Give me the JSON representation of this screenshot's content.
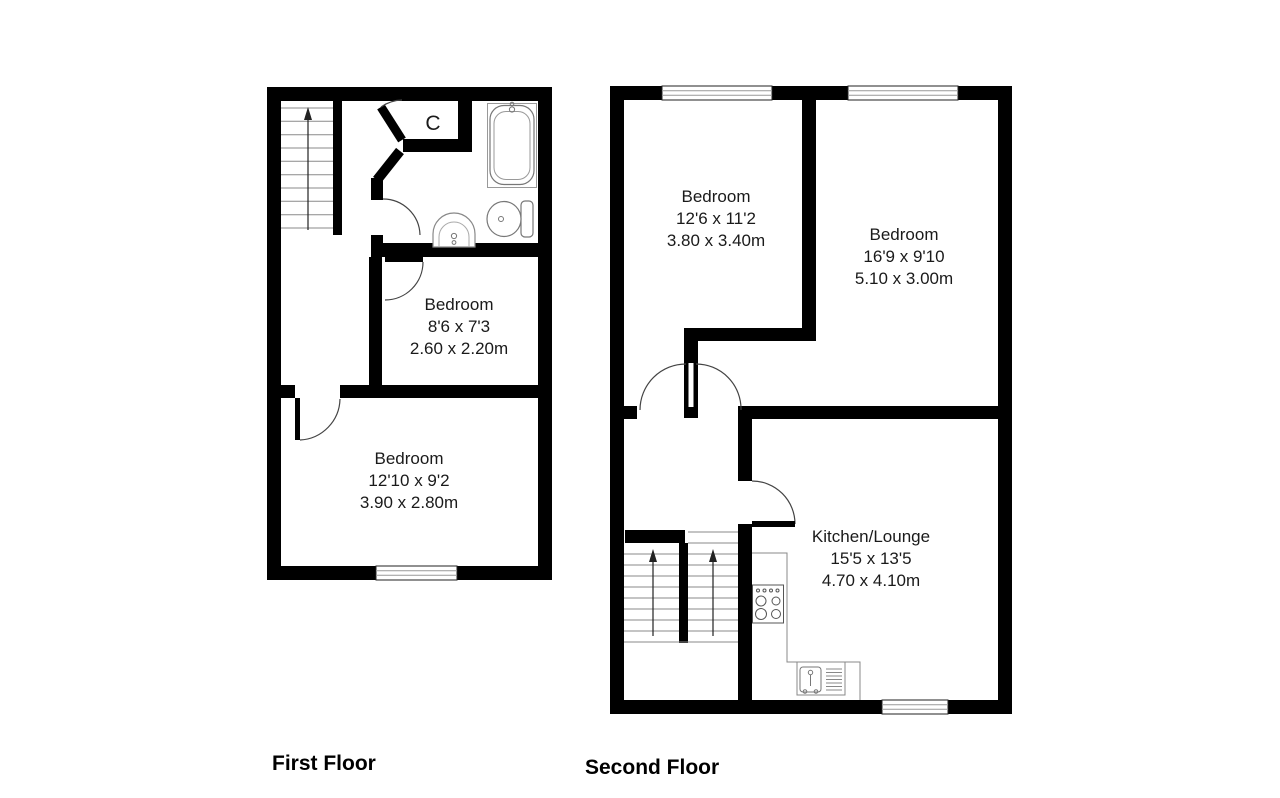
{
  "floors": [
    {
      "title": "First Floor",
      "closet_label": "C",
      "rooms": [
        {
          "name": "Bedroom",
          "size_imperial": "8'6 x 7'3",
          "size_metric": "2.60 x 2.20m"
        },
        {
          "name": "Bedroom",
          "size_imperial": "12'10 x 9'2",
          "size_metric": "3.90 x 2.80m"
        }
      ]
    },
    {
      "title": "Second Floor",
      "rooms": [
        {
          "name": "Bedroom",
          "size_imperial": "12'6 x 11'2",
          "size_metric": "3.80 x 3.40m"
        },
        {
          "name": "Bedroom",
          "size_imperial": "16'9 x 9'10",
          "size_metric": "5.10 x 3.00m"
        },
        {
          "name": "Kitchen/Lounge",
          "size_imperial": "15'5 x 13'5",
          "size_metric": "4.70 x 4.10m"
        }
      ]
    }
  ],
  "colors": {
    "wall": "#000000",
    "tread_line": "#8a8a8a",
    "door_arc": "#444444",
    "fixture": "#777777"
  }
}
